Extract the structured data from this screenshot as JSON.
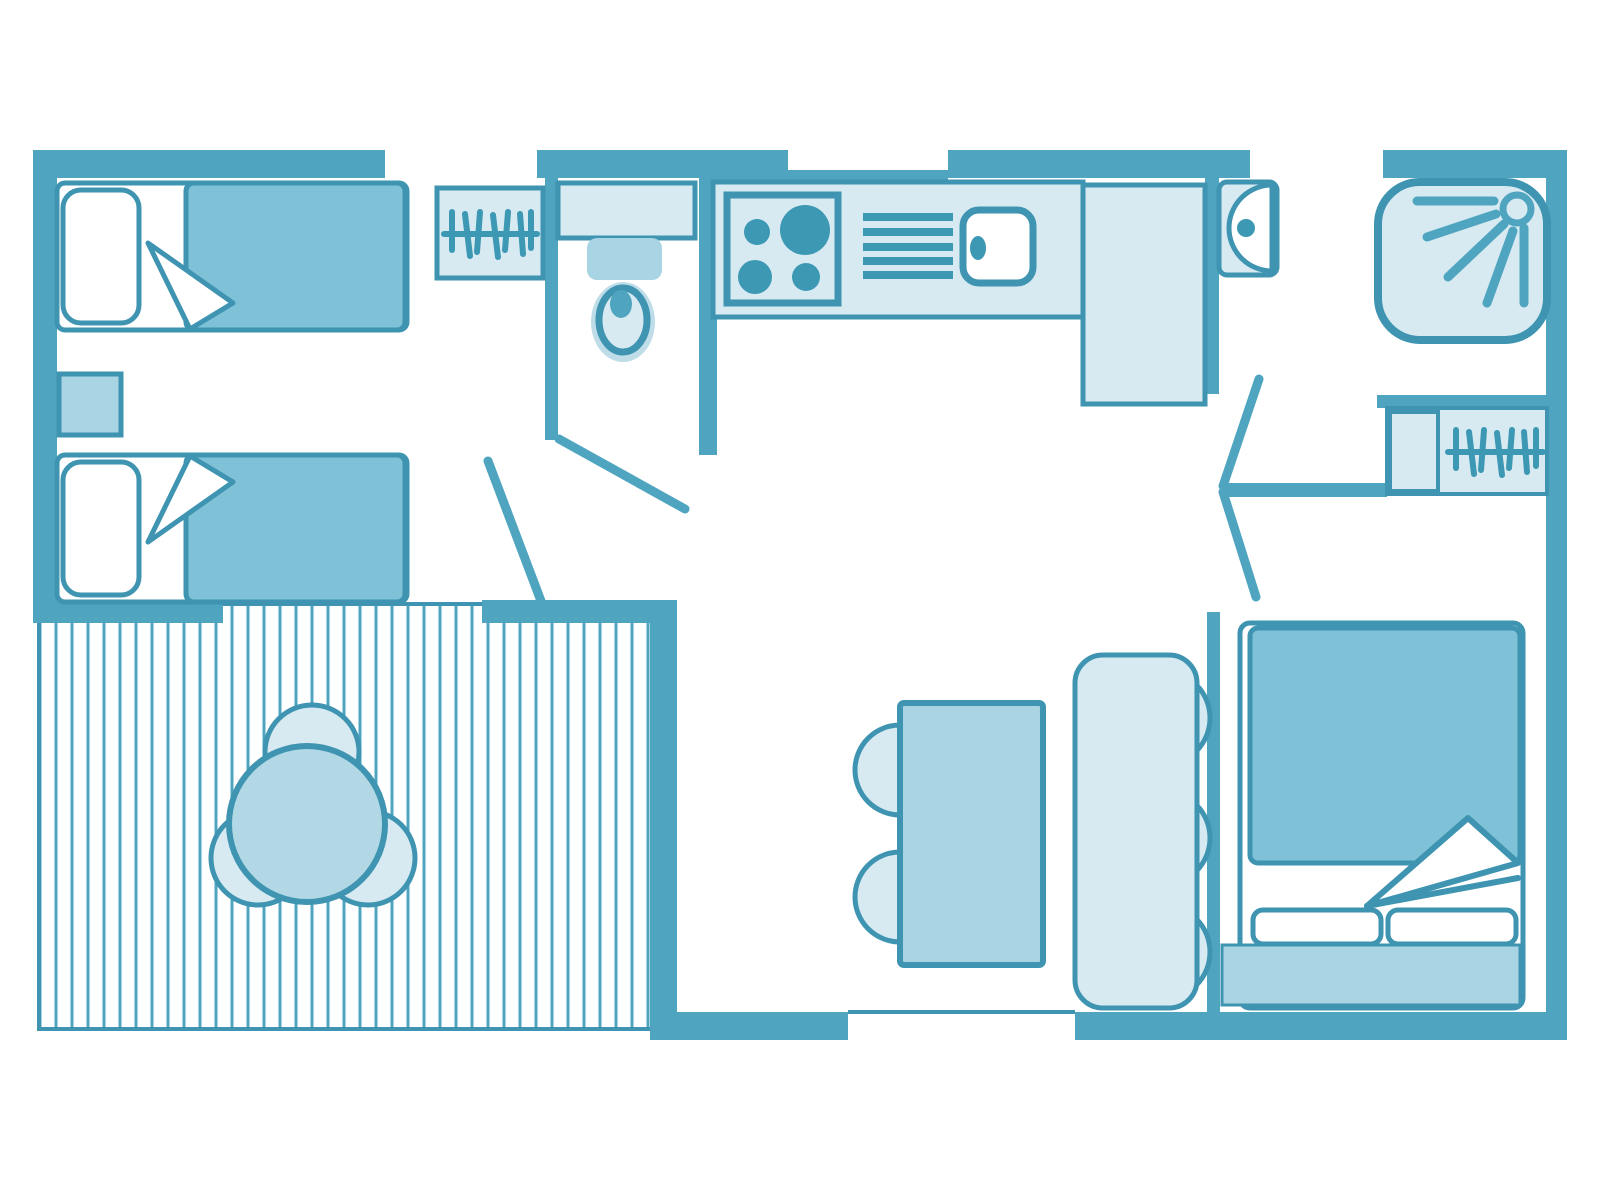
{
  "title": "Mobile home floor plan (top view, 2 bedrooms + terrace)",
  "canvas": {
    "width": 1600,
    "height": 1200,
    "background": "#ffffff"
  },
  "palette": {
    "background": "#ffffff",
    "wall": "#4FA5BF",
    "outline": "#3E94B1",
    "blanket": "#7FC2D7",
    "medium": "#A9D4E3",
    "terrace_table": "#B3D8E5",
    "light": "#D7EAF2",
    "soft": "#BFDDE9",
    "burner": "#3D98B4",
    "white": "#ffffff"
  },
  "rooms": [
    {
      "id": "twin-bedroom",
      "name": "Twin bedroom",
      "furniture": [
        "single bed 1",
        "single bed 2",
        "pillow",
        "duvet",
        "folded sheet corner",
        "nightstand",
        "wardrobe with hangers"
      ]
    },
    {
      "id": "wc",
      "name": "Toilet room",
      "furniture": [
        "toilet bowl",
        "cistern",
        "door"
      ]
    },
    {
      "id": "kitchen",
      "name": "Kitchen",
      "furniture": [
        "counter",
        "cooktop with 4 burners",
        "vent grill",
        "sink with faucet",
        "fridge cabinet"
      ]
    },
    {
      "id": "shower-room",
      "name": "Shower room",
      "furniture": [
        "shower tray with shower head",
        "washbasin"
      ]
    },
    {
      "id": "master-bedroom",
      "name": "Master bedroom",
      "furniture": [
        "double bed",
        "duvet",
        "folded sheet corner",
        "two pillows",
        "headboard shelf",
        "wardrobe with hangers",
        "double swing door"
      ]
    },
    {
      "id": "living-dining",
      "name": "Living / dining area",
      "furniture": [
        "dining table",
        "two half-round chairs",
        "bench with three cushions",
        "entrance threshold"
      ]
    },
    {
      "id": "terrace",
      "name": "Decked terrace",
      "furniture": [
        "deck boards",
        "round table",
        "three round chairs"
      ]
    }
  ],
  "icons": [
    "hanger-rail-icon",
    "shower-spray-icon",
    "cooktop-burners-icon",
    "vent-grill-icon"
  ]
}
